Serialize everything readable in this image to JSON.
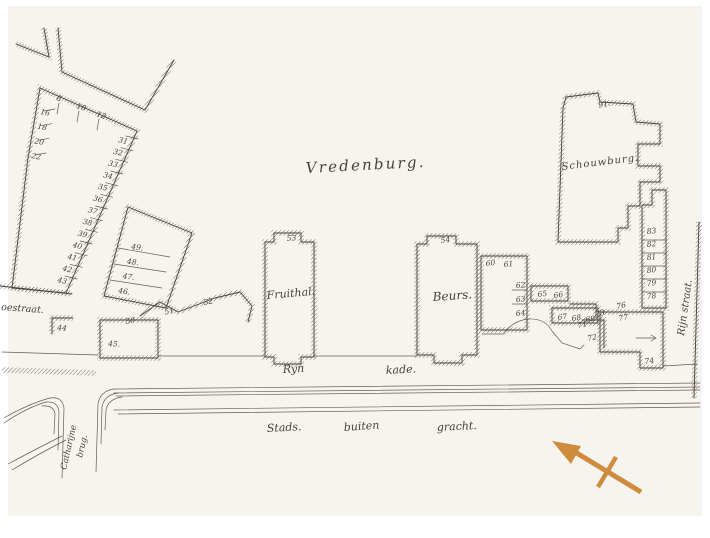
{
  "colors": {
    "ink": "#46423c",
    "paper": "#f6f4ee",
    "page": "#ffffff",
    "arrow": "#cf8c3f"
  },
  "map": {
    "area_label": "Vredenburg.",
    "streets": {
      "ryn": "Ryn",
      "kade": "kade.",
      "stads": "Stads.",
      "buiten": "buiten",
      "gracht": "gracht.",
      "oestraat": "oestraat.",
      "rijn_straat": "Rijn straat.",
      "catharijne": "Catharijne",
      "brug": "brug."
    },
    "buildings": {
      "fruithal": {
        "label": "Fruithal.",
        "number": "53"
      },
      "beurs": {
        "label": "Beurs.",
        "number": "54"
      },
      "schouwburg": {
        "label": "Schouwburg.",
        "number": "91."
      },
      "house45": {
        "number": "45."
      }
    },
    "plots": {
      "block_c_top": [
        "8",
        "10",
        "12"
      ],
      "block_c_left": [
        "16",
        "18",
        "20",
        "22"
      ],
      "block_c_street": [
        "31",
        "32",
        "33",
        "34",
        "35",
        "36",
        "37",
        "38",
        "39",
        "40",
        "41",
        "42",
        "43"
      ],
      "block_d": [
        "49.",
        "48.",
        "47.",
        "46."
      ],
      "zigzag": [
        "50",
        "51",
        "52"
      ],
      "corner_44": "44",
      "strip_e_top": [
        "60",
        "61"
      ],
      "strip_e_right": [
        "62",
        "63",
        "64"
      ],
      "strip_f": [
        "65",
        "66"
      ],
      "strip_g": [
        "67",
        "68",
        "69"
      ],
      "cluster_misc": {
        "n71": "71",
        "n72": "72",
        "n73": "73",
        "n76": "76",
        "n77": "77",
        "n74": "74"
      },
      "strip_j": [
        "83",
        "82",
        "81",
        "80",
        "79",
        "78"
      ]
    }
  }
}
